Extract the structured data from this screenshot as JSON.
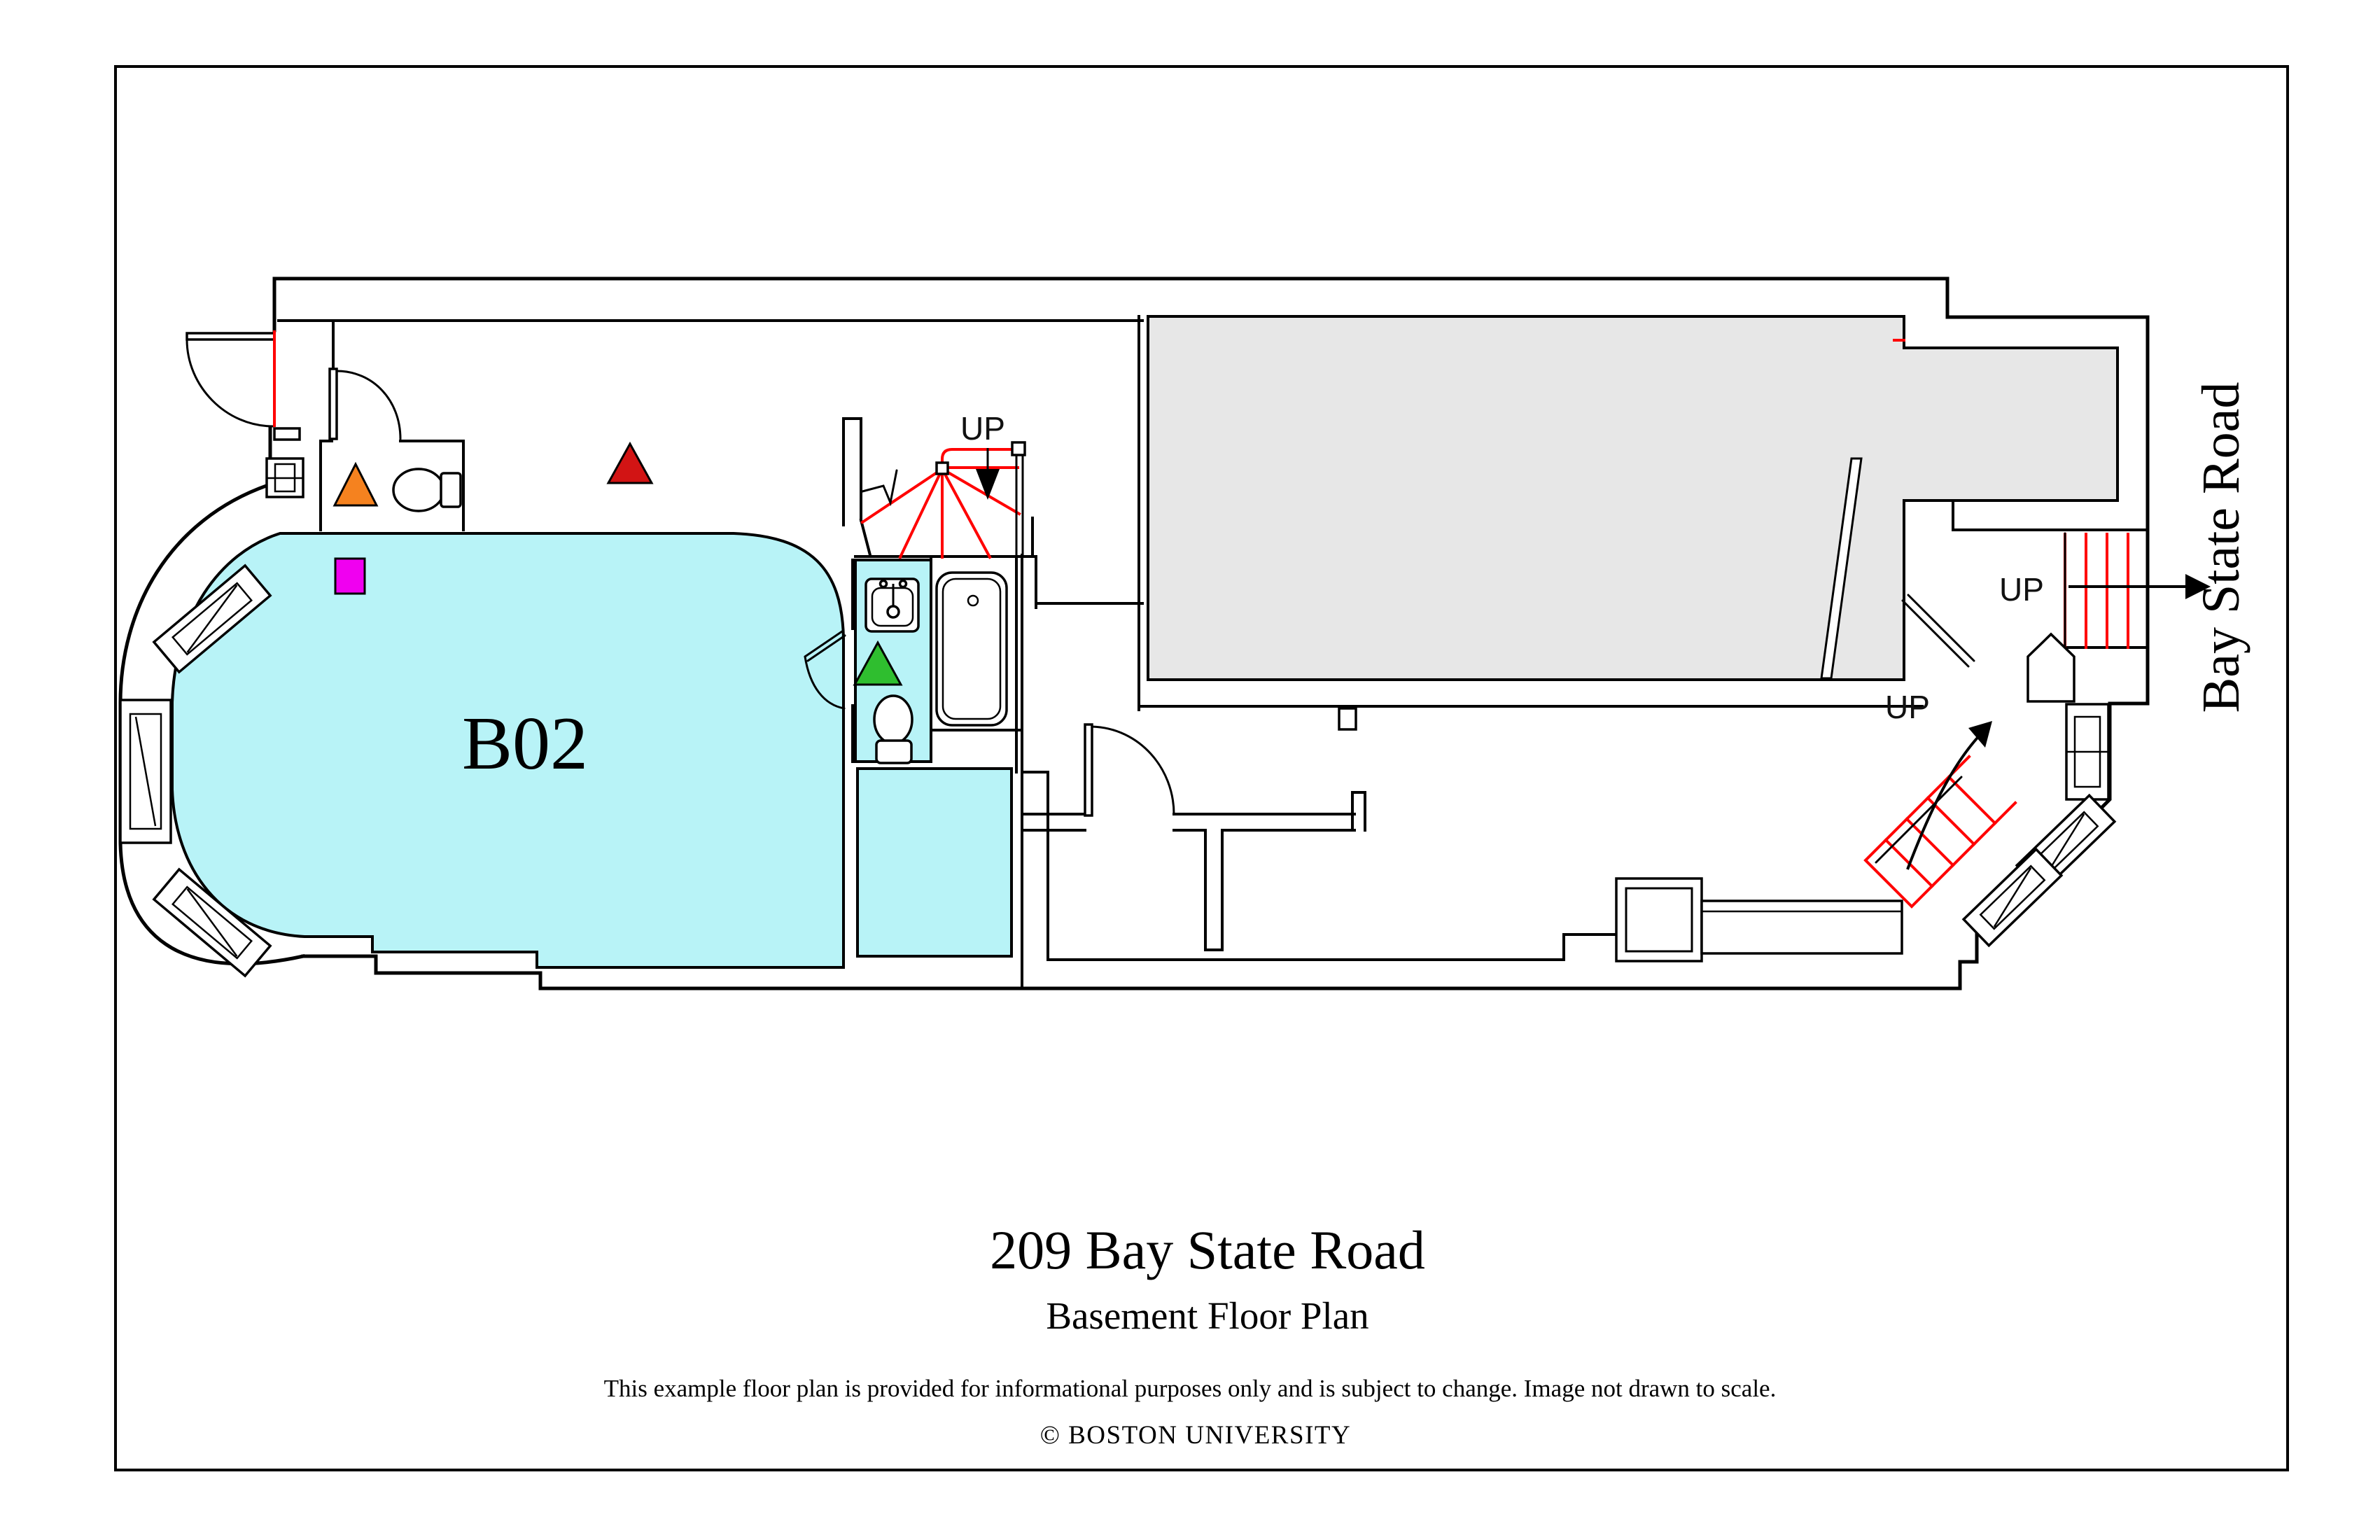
{
  "title_block": {
    "address": "209 Bay State Road",
    "plan_name": "Basement Floor Plan",
    "disclaimer": "This example floor plan is provided for informational purposes only and is subject to change. Image not drawn to scale.",
    "copyright": "© BOSTON UNIVERSITY"
  },
  "street_label": "Bay State Road",
  "rooms": {
    "main_room_label": "B02"
  },
  "stairs": {
    "up_label_center": "UP",
    "up_label_right": "UP",
    "up_label_winder": "UP"
  },
  "colors": {
    "room_fill": "#b8f3f7",
    "unfinished_fill": "#e7e7e7",
    "stair_red": "#ff0000",
    "marker_orange": "#f5821f",
    "marker_red": "#d21414",
    "marker_green": "#2fbe2f",
    "marker_magenta": "#f000f0",
    "wall_black": "#000000"
  }
}
